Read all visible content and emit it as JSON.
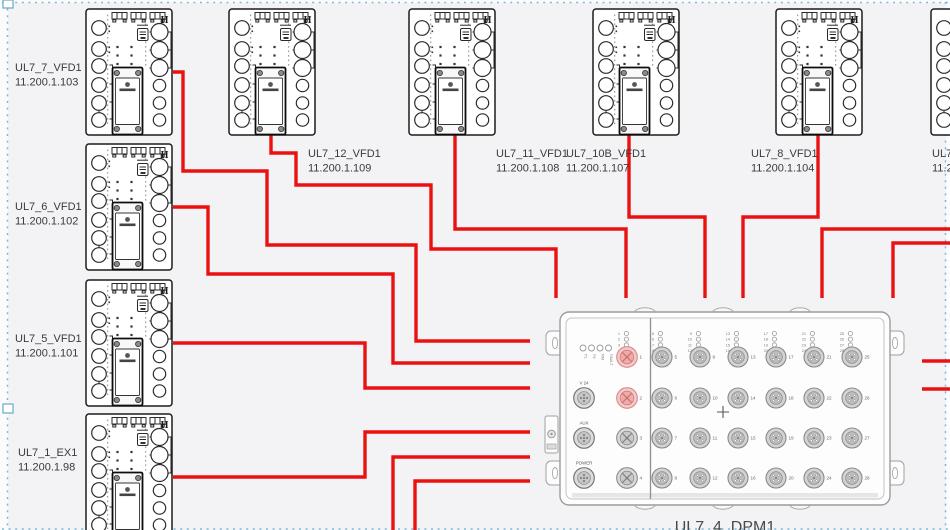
{
  "canvas": {
    "width": 950,
    "height": 530,
    "background": "#f3f3f5",
    "marquee_color": "#7cb9d9",
    "wire_color": "#ea1111",
    "highlight_port_fill": "#f6c9c9",
    "highlight_port_stroke": "#d98888"
  },
  "vfd_symbol": {
    "h_marker": "H"
  },
  "devices": [
    {
      "name": "UL7_7_VFD1",
      "ip": "11.200.1.103",
      "x": 85,
      "y": 8,
      "label": {
        "x": 15,
        "y": 71
      }
    },
    {
      "name": "UL7_6_VFD1",
      "ip": "11.200.1.102",
      "x": 85,
      "y": 143,
      "label": {
        "x": 15,
        "y": 210
      }
    },
    {
      "name": "UL7_5_VFD1",
      "ip": "11.200.1.101",
      "x": 85,
      "y": 279,
      "label": {
        "x": 15,
        "y": 342
      }
    },
    {
      "name": "UL7_1_EX1",
      "ip": "11.200.1.98",
      "x": 85,
      "y": 413,
      "label": {
        "x": 18,
        "y": 456
      }
    },
    {
      "name": "UL7_12_VFD1",
      "ip": "11.200.1.109",
      "x": 228,
      "y": 8,
      "label": {
        "x": 308,
        "y": 157
      }
    },
    {
      "name": "UL7_11_VFD1",
      "ip": "11.200.1.108",
      "x": 408,
      "y": 8,
      "label": {
        "x": 496,
        "y": 157
      }
    },
    {
      "name": "UL7_10B_VFD1",
      "ip": "11.200.1.107",
      "x": 592,
      "y": 8,
      "label": {
        "x": 566,
        "y": 157
      }
    },
    {
      "name": "UL7_8_VFD1",
      "ip": "11.200.1.104",
      "x": 775,
      "y": 8,
      "label": {
        "x": 751,
        "y": 157
      }
    },
    {
      "name": "UL7_",
      "ip": "11.2",
      "x": 930,
      "y": 8,
      "label": {
        "x": 932,
        "y": 157
      }
    }
  ],
  "dpm": {
    "name": "UL7_4_DPM1",
    "x": 560,
    "y": 312,
    "w": 330,
    "h": 193,
    "status_leds": [
      "P1",
      "P2",
      "RM",
      "FAULT"
    ],
    "power_ports": [
      {
        "label": "V 24",
        "y": 398
      },
      {
        "label": "AUX",
        "y": 438
      },
      {
        "label": "POWER",
        "y": 478
      }
    ],
    "left_ports": [
      {
        "num": 1,
        "y": 357,
        "highlight": true
      },
      {
        "num": 2,
        "y": 398,
        "highlight": true
      },
      {
        "num": 3,
        "y": 438,
        "highlight": false
      },
      {
        "num": 4,
        "y": 478,
        "highlight": false
      }
    ],
    "led_group_left": [
      1,
      2,
      3,
      4
    ],
    "data_columns": [
      {
        "x": 662,
        "ports": [
          5,
          6,
          7,
          8
        ]
      },
      {
        "x": 700,
        "ports": [
          9,
          10,
          11,
          12
        ]
      },
      {
        "x": 738,
        "ports": [
          13,
          14,
          15,
          16
        ]
      },
      {
        "x": 776,
        "ports": [
          17,
          18,
          19,
          20
        ]
      },
      {
        "x": 814,
        "ports": [
          21,
          22,
          23,
          24
        ]
      },
      {
        "x": 852,
        "ports": [
          25,
          26,
          27,
          28
        ]
      }
    ],
    "row_ys": [
      357,
      398,
      438,
      478
    ],
    "center_marker": "+",
    "label_x": 725,
    "label_y": 532
  },
  "wires": [
    {
      "id": "ul7_7",
      "points": [
        [
          173,
          72
        ],
        [
          183,
          72
        ],
        [
          183,
          171
        ],
        [
          267,
          171
        ],
        [
          267,
          245
        ],
        [
          416,
          245
        ],
        [
          416,
          341
        ],
        [
          530,
          341
        ]
      ]
    },
    {
      "id": "ul7_6",
      "points": [
        [
          173,
          207
        ],
        [
          208,
          207
        ],
        [
          208,
          274
        ],
        [
          393,
          274
        ],
        [
          393,
          363
        ],
        [
          530,
          363
        ]
      ]
    },
    {
      "id": "ul7_5",
      "points": [
        [
          173,
          343
        ],
        [
          365,
          343
        ],
        [
          365,
          388
        ],
        [
          530,
          388
        ]
      ]
    },
    {
      "id": "ul7_1",
      "points": [
        [
          173,
          477
        ],
        [
          365,
          477
        ],
        [
          365,
          432
        ],
        [
          530,
          432
        ]
      ]
    },
    {
      "id": "from-below-1",
      "points": [
        [
          393,
          532
        ],
        [
          393,
          457
        ],
        [
          530,
          457
        ]
      ]
    },
    {
      "id": "from-below-2",
      "points": [
        [
          415,
          532
        ],
        [
          415,
          481
        ],
        [
          530,
          481
        ]
      ]
    },
    {
      "id": "ul7_12",
      "points": [
        [
          271,
          135
        ],
        [
          271,
          153
        ],
        [
          296,
          153
        ],
        [
          296,
          185
        ],
        [
          431,
          185
        ],
        [
          431,
          249
        ],
        [
          556,
          249
        ],
        [
          556,
          298
        ]
      ]
    },
    {
      "id": "ul7_11",
      "points": [
        [
          455,
          135
        ],
        [
          455,
          229
        ],
        [
          626,
          229
        ],
        [
          626,
          298
        ]
      ]
    },
    {
      "id": "ul7_10b",
      "points": [
        [
          629,
          135
        ],
        [
          629,
          217
        ],
        [
          705,
          217
        ],
        [
          705,
          298
        ]
      ]
    },
    {
      "id": "ul7_8",
      "points": [
        [
          818,
          135
        ],
        [
          818,
          217
        ],
        [
          743,
          217
        ],
        [
          743,
          298
        ]
      ]
    },
    {
      "id": "from-right-1",
      "points": [
        [
          952,
          229
        ],
        [
          822,
          229
        ],
        [
          822,
          298
        ]
      ]
    },
    {
      "id": "from-right-2",
      "points": [
        [
          952,
          243
        ],
        [
          893,
          243
        ],
        [
          893,
          298
        ]
      ]
    },
    {
      "id": "dpm-right-1",
      "points": [
        [
          922,
          361
        ],
        [
          952,
          361
        ]
      ]
    },
    {
      "id": "dpm-right-2",
      "points": [
        [
          922,
          389
        ],
        [
          952,
          389
        ]
      ]
    }
  ]
}
